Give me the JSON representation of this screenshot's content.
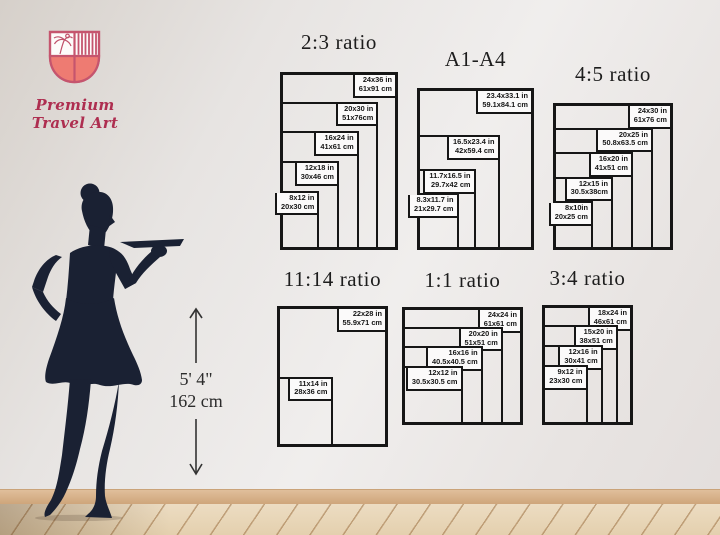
{
  "logo": {
    "brand": "Premium Travel Art"
  },
  "palette": {
    "shield_outline": "#c5556e",
    "shield_fill": "#ee7b72",
    "brand_text": "#ae2e50",
    "line_color": "#161616",
    "silhouette": "#1a2133",
    "wall": "#ece9e8",
    "floor": "#e7d4b4"
  },
  "height_marker": {
    "line1": "5' 4\"",
    "line2": "162 cm"
  },
  "charts": [
    {
      "title": "2:3 ratio",
      "layout": {
        "left": 280,
        "top": 72,
        "width": 118,
        "height": 178,
        "titleTop": 30
      },
      "sizes": [
        {
          "in": "24x36 in",
          "cm": "61x91 cm",
          "w": 24,
          "h": 36
        },
        {
          "in": "20x30 in",
          "cm": "51x76cm",
          "w": 20,
          "h": 30
        },
        {
          "in": "16x24 in",
          "cm": "41x61 cm",
          "w": 16,
          "h": 24
        },
        {
          "in": "12x18 in",
          "cm": "30x46 cm",
          "w": 12,
          "h": 18
        },
        {
          "in": "8x12 in",
          "cm": "20x30 cm",
          "w": 8,
          "h": 12
        }
      ]
    },
    {
      "title": "A1-A4",
      "layout": {
        "left": 417,
        "top": 88,
        "width": 117,
        "height": 162,
        "titleTop": 47
      },
      "sizes": [
        {
          "in": "23.4x33.1 in",
          "cm": "59.1x84.1 cm",
          "w": 23.4,
          "h": 33.1
        },
        {
          "in": "16.5x23.4 in",
          "cm": "42x59.4 cm",
          "w": 16.5,
          "h": 23.4
        },
        {
          "in": "11.7x16.5 in",
          "cm": "29.7x42 cm",
          "w": 11.7,
          "h": 16.5
        },
        {
          "in": "8.3x11.7 in",
          "cm": "21x29.7 cm",
          "w": 8.3,
          "h": 11.7
        }
      ]
    },
    {
      "title": "4:5 ratio",
      "layout": {
        "left": 553,
        "top": 103,
        "width": 120,
        "height": 147,
        "titleTop": 62
      },
      "sizes": [
        {
          "in": "24x30 in",
          "cm": "61x76 cm",
          "w": 24,
          "h": 30
        },
        {
          "in": "20x25 in",
          "cm": "50.8x63.5 cm",
          "w": 20,
          "h": 25
        },
        {
          "in": "16x20 in",
          "cm": "41x51 cm",
          "w": 16,
          "h": 20
        },
        {
          "in": "12x15 in",
          "cm": "30.5x38cm",
          "w": 12,
          "h": 15
        },
        {
          "in": "8x10in",
          "cm": "20x25 cm",
          "w": 8,
          "h": 10
        }
      ]
    },
    {
      "title": "11:14 ratio",
      "layout": {
        "left": 277,
        "top": 306,
        "width": 111,
        "height": 141,
        "titleTop": 267
      },
      "sizes": [
        {
          "in": "22x28 in",
          "cm": "55.9x71 cm",
          "w": 22,
          "h": 28
        },
        {
          "in": "11x14 in",
          "cm": "28x36 cm",
          "w": 11,
          "h": 14
        }
      ]
    },
    {
      "title": "1:1 ratio",
      "layout": {
        "left": 402,
        "top": 307,
        "width": 121,
        "height": 118,
        "titleTop": 268
      },
      "sizes": [
        {
          "in": "24x24 in",
          "cm": "61x61 cm",
          "w": 24,
          "h": 24
        },
        {
          "in": "20x20 in",
          "cm": "51x51 cm",
          "w": 20,
          "h": 20
        },
        {
          "in": "16x16 in",
          "cm": "40.5x40.5 cm",
          "w": 16,
          "h": 16
        },
        {
          "in": "12x12 in",
          "cm": "30.5x30.5 cm",
          "w": 12,
          "h": 12
        }
      ]
    },
    {
      "title": "3:4 ratio",
      "layout": {
        "left": 542,
        "top": 305,
        "width": 91,
        "height": 120,
        "titleTop": 266
      },
      "sizes": [
        {
          "in": "18x24 in",
          "cm": "46x61 cm",
          "w": 18,
          "h": 24
        },
        {
          "in": "15x20 in",
          "cm": "38x51 cm",
          "w": 15,
          "h": 20
        },
        {
          "in": "12x16 in",
          "cm": "30x41 cm",
          "w": 12,
          "h": 16
        },
        {
          "in": "9x12 in",
          "cm": "23x30 cm",
          "w": 9,
          "h": 12
        }
      ]
    }
  ]
}
